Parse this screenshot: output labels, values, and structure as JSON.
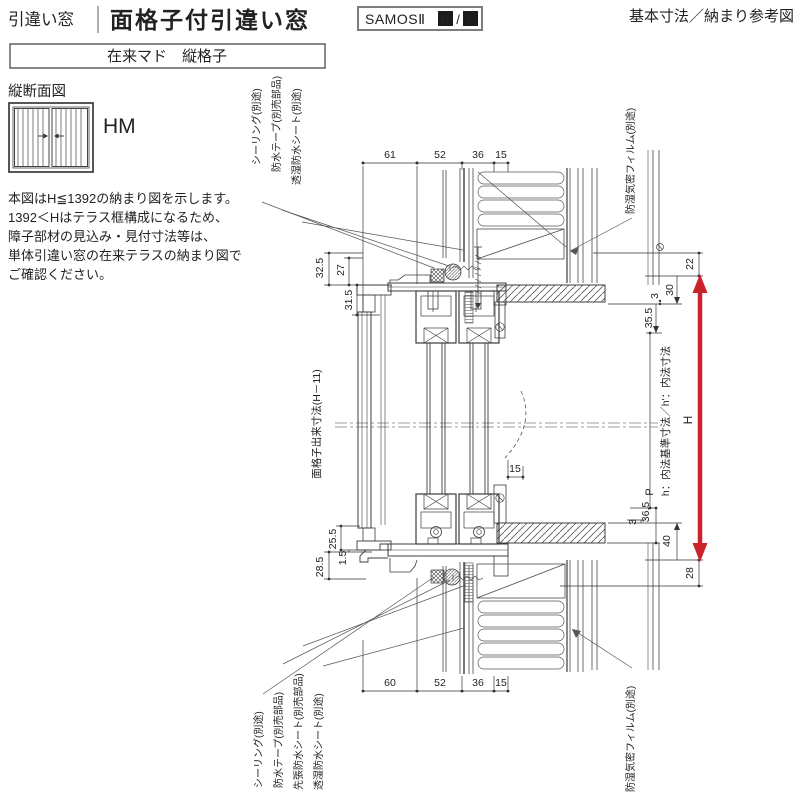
{
  "header": {
    "category": "引違い窓",
    "title": "面格子付引違い窓",
    "brand": "SAMOSⅡ",
    "brand_h": "H",
    "brand_sep": "/",
    "brand_l": "L",
    "doc_type": "基本寸法／納まり参考図",
    "variant": "在来マド　縦格子"
  },
  "side": {
    "section_title": "縦断面図",
    "model_code": "HM",
    "notes": [
      "本図はH≦1392の納まり図を示します。",
      "1392＜Hはテラス框構成になるため、",
      "障子部材の見込み・見付寸法等は、",
      "単体引違い窓の在来テラスの納まり図で",
      "ご確認ください。"
    ]
  },
  "annotations": {
    "top_left": [
      "シーリング(別途)",
      "防水テープ(別売部品)",
      "透湿防水シート(別途)"
    ],
    "film": "防湿気密フィルム(別途)",
    "bottom_left": [
      "シーリング(別途)",
      "防水テープ(別売部品)",
      "先張防水シート(別売部品)",
      "透湿防水シート(別途)"
    ],
    "grille_height": "面格子出来寸法(H－11)",
    "inner_height": "h：内法基準寸法／h'：内法寸法",
    "height_symbol": "H",
    "p_symbol": "P"
  },
  "dimensions": {
    "top": [
      "61",
      "52",
      "36",
      "15"
    ],
    "bottom": [
      "60",
      "52",
      "36",
      "15"
    ],
    "left_upper": [
      "32.5",
      "27",
      "31.5"
    ],
    "left_lower": [
      "25.5",
      "1.5",
      "28.5"
    ],
    "right_upper": [
      "22",
      "30",
      "3",
      "35.5"
    ],
    "right_lower": [
      "36.5",
      "3",
      "40",
      "28"
    ],
    "center": "15"
  },
  "colors": {
    "accent_red": "#c9242b",
    "line": "#4a4a4a"
  }
}
